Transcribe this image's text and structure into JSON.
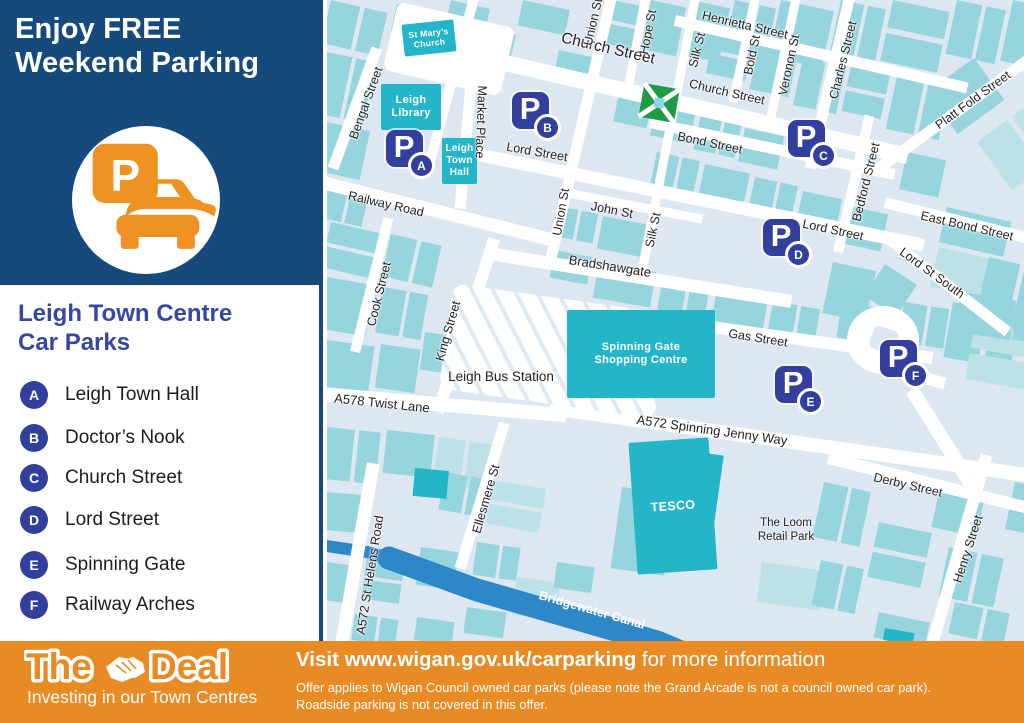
{
  "palette": {
    "header_blue": "#174a7c",
    "accent_blue": "#323f9c",
    "title_blue": "#3547a3",
    "orange": "#e98b25",
    "icon_orange": "#ef9224",
    "map_bg": "#dce7f2",
    "block_teal": "#96d5dd",
    "block_teal_light": "#bce2e8",
    "landmark_cyan": "#25b5c8",
    "canal_blue": "#2e87c7",
    "park_green": "#1f9b48",
    "text_dark": "#231f20"
  },
  "sidebar": {
    "heading_line1": "Enjoy FREE",
    "heading_line2": "Weekend Parking",
    "parking_icon_letter": "P",
    "subheading_line1": "Leigh Town Centre",
    "subheading_line2": "Car Parks",
    "car_parks": [
      {
        "letter": "A",
        "name": "Leigh Town Hall"
      },
      {
        "letter": "B",
        "name": "Doctor’s Nook"
      },
      {
        "letter": "C",
        "name": "Church Street"
      },
      {
        "letter": "D",
        "name": "Lord Street"
      },
      {
        "letter": "E",
        "name": "Spinning Gate"
      },
      {
        "letter": "F",
        "name": "Railway Arches"
      }
    ]
  },
  "map": {
    "street_labels": [
      {
        "text": "Church Street",
        "x": 281,
        "y": 49,
        "rot": 13,
        "size": 15.5
      },
      {
        "text": "Henrietta Street",
        "x": 418,
        "y": 25,
        "rot": 13,
        "size": 12.5
      },
      {
        "text": "Union St",
        "x": 266,
        "y": 22,
        "rot": -77,
        "size": 12.5
      },
      {
        "text": "Hope St",
        "x": 321,
        "y": 32,
        "rot": -79,
        "size": 12.5
      },
      {
        "text": "Silk St",
        "x": 370,
        "y": 50,
        "rot": -76,
        "size": 12.5
      },
      {
        "text": "Bold St",
        "x": 425,
        "y": 55,
        "rot": -78,
        "size": 12.5
      },
      {
        "text": "Veronon St",
        "x": 462,
        "y": 65,
        "rot": -78,
        "size": 12.5
      },
      {
        "text": "Charles Street",
        "x": 516,
        "y": 60,
        "rot": -76,
        "size": 12.5
      },
      {
        "text": "Platt Fold Street",
        "x": 646,
        "y": 100,
        "rot": -36,
        "size": 12.5
      },
      {
        "text": "Church Street",
        "x": 400,
        "y": 92,
        "rot": 13,
        "size": 12.5
      },
      {
        "text": "Bond Street",
        "x": 383,
        "y": 143,
        "rot": 12,
        "size": 12.5
      },
      {
        "text": "Lord Street",
        "x": 210,
        "y": 152,
        "rot": 10,
        "size": 12.5
      },
      {
        "text": "Lord Street",
        "x": 506,
        "y": 230,
        "rot": 12,
        "size": 12.5
      },
      {
        "text": "East Bond Street",
        "x": 640,
        "y": 226,
        "rot": 13,
        "size": 12.5
      },
      {
        "text": "Lord St South",
        "x": 605,
        "y": 273,
        "rot": 36,
        "size": 12.5
      },
      {
        "text": "Bedford Street",
        "x": 539,
        "y": 182,
        "rot": -76,
        "size": 12.5
      },
      {
        "text": "John St",
        "x": 285,
        "y": 210,
        "rot": 11,
        "size": 12.5
      },
      {
        "text": "Silk St",
        "x": 326,
        "y": 230,
        "rot": -78,
        "size": 12.5
      },
      {
        "text": "Union St",
        "x": 234,
        "y": 212,
        "rot": -80,
        "size": 12.5
      },
      {
        "text": "Bradshawgate",
        "x": 283,
        "y": 266,
        "rot": 9,
        "size": 13
      },
      {
        "text": "Gas Street",
        "x": 431,
        "y": 338,
        "rot": 9,
        "size": 12.5
      },
      {
        "text": "Railway Road",
        "x": 59,
        "y": 204,
        "rot": 13,
        "size": 12.5
      },
      {
        "text": "Bengal Street",
        "x": 39,
        "y": 103,
        "rot": -70,
        "size": 12.5
      },
      {
        "text": "Market Place",
        "x": 154,
        "y": 122,
        "rot": 92,
        "size": 12.5
      },
      {
        "text": "Cook Street",
        "x": 52,
        "y": 294,
        "rot": -76,
        "size": 12.5
      },
      {
        "text": "King Street",
        "x": 121,
        "y": 331,
        "rot": -74,
        "size": 12.5
      },
      {
        "text": "A578 Twist Lane",
        "x": 55,
        "y": 403,
        "rot": 6,
        "size": 13
      },
      {
        "text": "A572 Spinning Jenny Way",
        "x": 385,
        "y": 430,
        "rot": 8,
        "size": 13
      },
      {
        "text": "Derby Street",
        "x": 581,
        "y": 485,
        "rot": 13,
        "size": 12.5
      },
      {
        "text": "Ellesmere St",
        "x": 159,
        "y": 499,
        "rot": -74,
        "size": 12.5
      },
      {
        "text": "A572 St Helens Road",
        "x": 43,
        "y": 575,
        "rot": -81,
        "size": 12.5
      },
      {
        "text": "Henry Street",
        "x": 641,
        "y": 549,
        "rot": -72,
        "size": 12.5
      },
      {
        "text": "Bridgewater Canal",
        "x": 265,
        "y": 610,
        "rot": 16,
        "size": 12.5,
        "color": "#ffffff"
      }
    ],
    "place_labels": [
      {
        "lines": [
          "Leigh Bus Station"
        ],
        "x": 174,
        "y": 377,
        "size": 13.5
      },
      {
        "lines": [
          "The Loom",
          "Retail Park"
        ],
        "x": 459,
        "y": 530,
        "size": 11.5
      }
    ],
    "landmarks": [
      {
        "lines": [
          "St Mary’s",
          "Church"
        ],
        "x": 76,
        "y": 22,
        "w": 52,
        "h": 32,
        "rot": -6,
        "fs": 8.5
      },
      {
        "lines": [
          "Leigh",
          "Library"
        ],
        "x": 54,
        "y": 84,
        "w": 60,
        "h": 46,
        "rot": 0,
        "fs": 11
      },
      {
        "lines": [
          "Leigh",
          "Town",
          "Hall"
        ],
        "x": 115,
        "y": 138,
        "w": 35,
        "h": 46,
        "rot": 0,
        "fs": 10
      },
      {
        "lines": [
          "Spinning Gate",
          "Shopping Centre"
        ],
        "x": 240,
        "y": 310,
        "w": 148,
        "h": 88,
        "rot": 0,
        "fs": 11
      },
      {
        "lines": [
          "TESCO"
        ],
        "x": 306,
        "y": 440,
        "w": 80,
        "h": 132,
        "rot": -4,
        "fs": 12.5
      }
    ],
    "markers": [
      {
        "letter": "A",
        "x": 59,
        "y": 130
      },
      {
        "letter": "B",
        "x": 185,
        "y": 92
      },
      {
        "letter": "C",
        "x": 461,
        "y": 120
      },
      {
        "letter": "D",
        "x": 436,
        "y": 219
      },
      {
        "letter": "E",
        "x": 448,
        "y": 366
      },
      {
        "letter": "F",
        "x": 553,
        "y": 340
      }
    ]
  },
  "footer": {
    "logo_word1": "The",
    "logo_word2": "Deal",
    "tagline": "Investing in our Town Centres",
    "visit_bold": "Visit www.wigan.gov.uk/carparking",
    "visit_rest": " for more information",
    "disclaimer_line1": "Offer applies to Wigan Council owned car parks (please note the Grand Arcade is not a council owned car park).",
    "disclaimer_line2": "Roadside parking is not covered in this offer."
  }
}
